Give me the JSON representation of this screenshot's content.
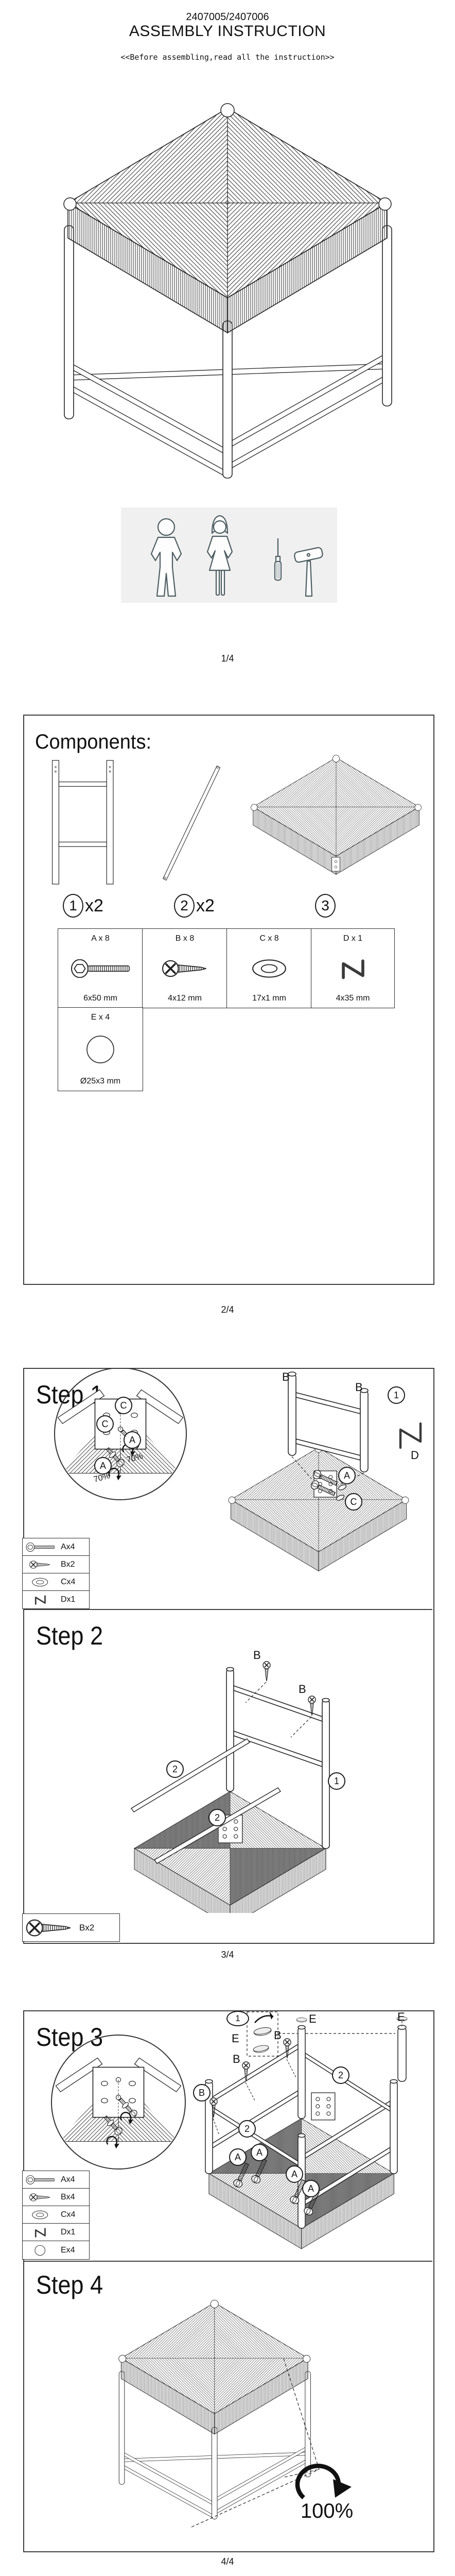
{
  "header": {
    "model": "2407005/2407006",
    "title": "ASSEMBLY INSTRUCTION",
    "subtitle": "<<Before assembling,read all the instruction>>"
  },
  "footers": {
    "p1": "1/4",
    "p2": "2/4",
    "p3": "3/4",
    "p4": "4/4"
  },
  "components": {
    "heading": "Components:",
    "parts": [
      {
        "num": "1",
        "qty": "x2",
        "icon": "h-frame-leg-panel"
      },
      {
        "num": "2",
        "qty": "x2",
        "icon": "stretcher-rod"
      },
      {
        "num": "3",
        "qty": "",
        "icon": "woven-seat-top"
      }
    ],
    "hardware": [
      {
        "code": "A x 8",
        "size": "6x50 mm",
        "icon": "bolt"
      },
      {
        "code": "B x 8",
        "size": "4x12 mm",
        "icon": "screw"
      },
      {
        "code": "C x 8",
        "size": "17x1 mm",
        "icon": "washer"
      },
      {
        "code": "D x 1",
        "size": "4x35 mm",
        "icon": "allen-key"
      },
      {
        "code": "E x 4",
        "size": "Ø25x3 mm",
        "icon": "glide-disc"
      }
    ]
  },
  "steps": {
    "s1": {
      "heading": "Step 1",
      "mag": {
        "c1": "C",
        "c2": "C",
        "a1": "A",
        "a2": "A",
        "p1": "70%",
        "p2": "70%"
      },
      "lbl": {
        "b1": "B",
        "b2": "B",
        "a": "A",
        "c": "C",
        "d": "D",
        "part": "1"
      },
      "legend": [
        {
          "item": "Ax4",
          "icon": "bolt"
        },
        {
          "item": "Bx2",
          "icon": "screw"
        },
        {
          "item": "Cx4",
          "icon": "washer"
        },
        {
          "item": "Dx1",
          "icon": "allen-key"
        }
      ]
    },
    "s2": {
      "heading": "Step 2",
      "lbl": {
        "b1": "B",
        "b2": "B",
        "rod1": "2",
        "rod2": "2",
        "part": "1"
      },
      "legend": [
        {
          "item": "Bx2",
          "icon": "screw"
        }
      ]
    },
    "s3": {
      "heading": "Step 3",
      "detail": {
        "part": "1",
        "e1": "E",
        "e2": "E"
      },
      "lbl": {
        "b1": "B",
        "b2": "B",
        "b3": "B",
        "e1": "E",
        "rod1": "2",
        "rod2": "2",
        "a1": "A",
        "a2": "A",
        "a3": "A",
        "a4": "A"
      },
      "legend": [
        {
          "item": "Ax4",
          "icon": "bolt"
        },
        {
          "item": "Bx4",
          "icon": "screw"
        },
        {
          "item": "Cx4",
          "icon": "washer"
        },
        {
          "item": "Dx1",
          "icon": "allen-key"
        },
        {
          "item": "Ex4",
          "icon": "glide-disc"
        }
      ]
    },
    "s4": {
      "heading": "Step 4",
      "percent": "100%"
    }
  }
}
